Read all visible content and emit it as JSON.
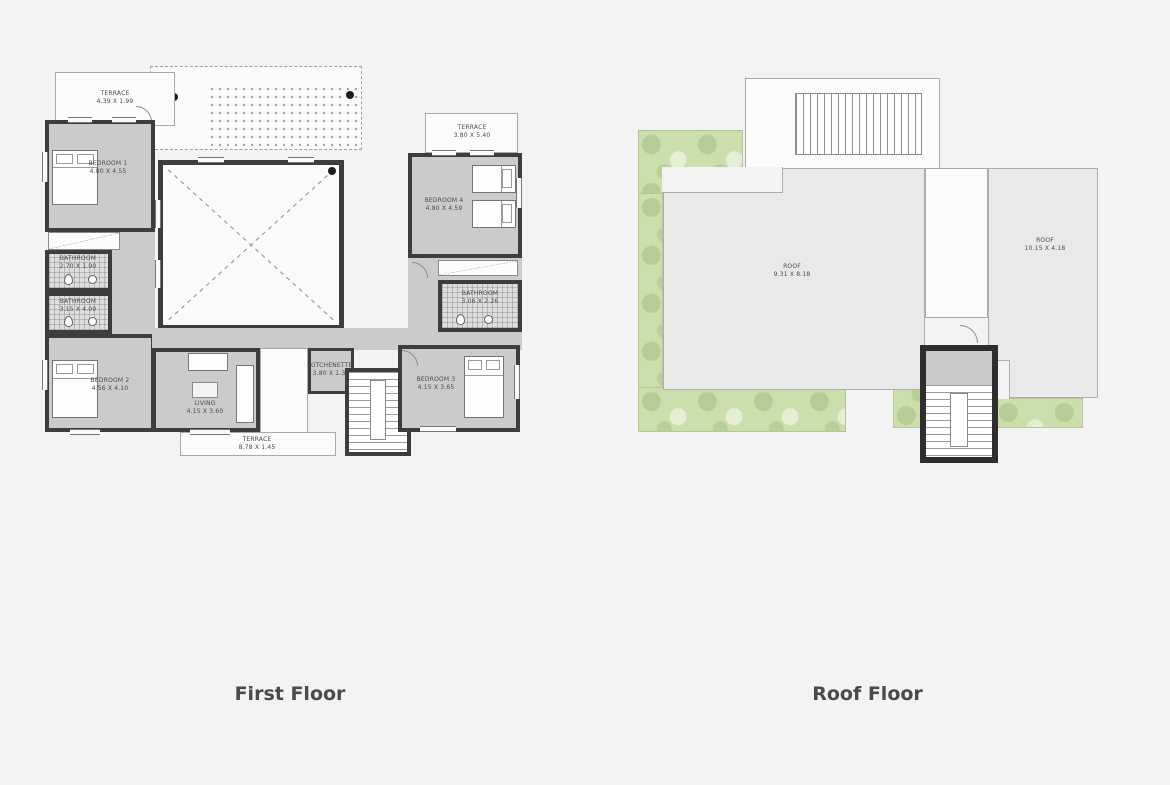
{
  "page": {
    "type": "floor-plan-sheet"
  },
  "colors": {
    "background": "#f3f3f4",
    "wall": "#3d3d3d",
    "wall-dark": "#2e2e2e",
    "room-fill": "#cbcbcb",
    "roof-fill": "#e9e9e9",
    "green": "#cbdfad",
    "label": "#4a4a4a",
    "title": "#4a4a4a"
  },
  "first_floor": {
    "title": "First Floor",
    "labels": {
      "terrace_nw": {
        "name": "TERRACE",
        "dims": "4.39 X 1.99"
      },
      "bedroom_1": {
        "name": "BEDROOM 1",
        "dims": "4.80 X 4.55"
      },
      "bathroom_a": {
        "name": "BATHROOM",
        "dims": "2.70 X 1.90"
      },
      "bathroom_b": {
        "name": "BATHROOM",
        "dims": "3.15 X 4.00"
      },
      "bedroom_2": {
        "name": "BEDROOM 2",
        "dims": "4.56 X 4.10"
      },
      "living": {
        "name": "LIVING",
        "dims": "4.15 X 3.60"
      },
      "kitchenette": {
        "name": "KITCHENETTE",
        "dims": "3.80 X 1.30"
      },
      "terrace_s": {
        "name": "TERRACE",
        "dims": "8.78 X 1.45"
      },
      "terrace_ne": {
        "name": "TERRACE",
        "dims": "3.80 X 5.40"
      },
      "bedroom_4": {
        "name": "BEDROOM 4",
        "dims": "4.80 X 4.59"
      },
      "bathroom_c": {
        "name": "BATHROOM",
        "dims": "3.06 X 2.26"
      },
      "bedroom_3": {
        "name": "BEDROOM 3",
        "dims": "4.15 X 3.65"
      }
    }
  },
  "roof_floor": {
    "title": "Roof Floor",
    "labels": {
      "roof_main": {
        "name": "ROOF",
        "dims": "9.31 X 8.18"
      },
      "roof_right": {
        "name": "ROOF",
        "dims": "10.15 X 4.18"
      }
    }
  }
}
